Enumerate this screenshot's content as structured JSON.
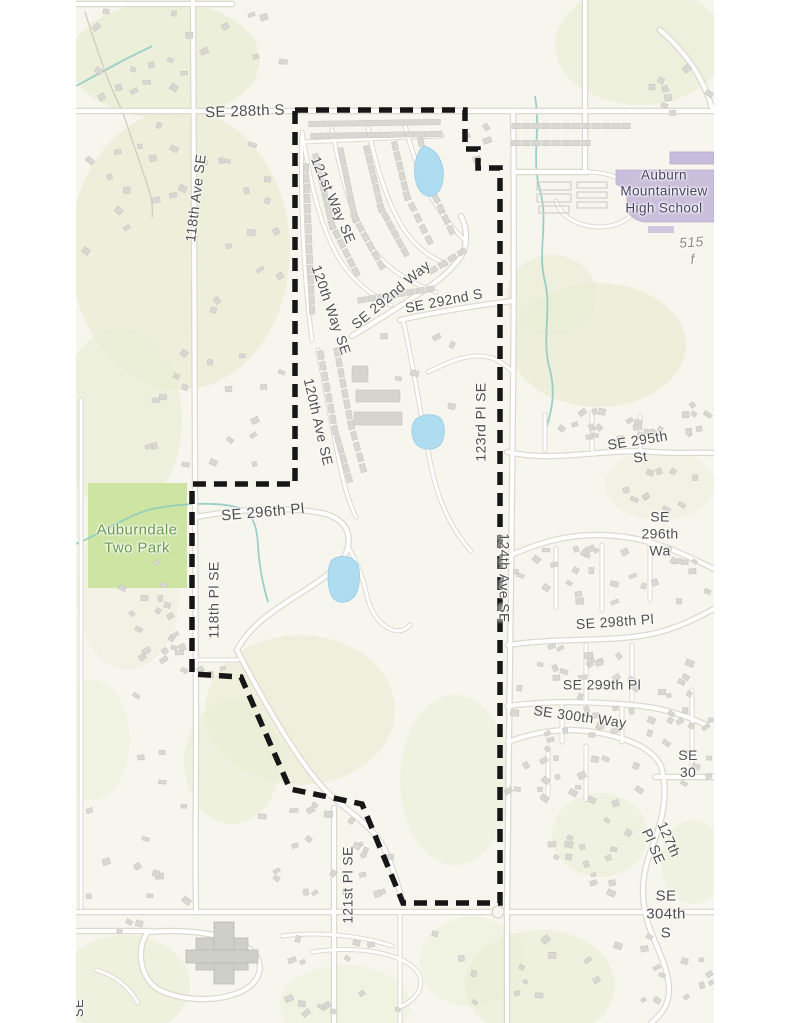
{
  "map": {
    "type": "street-map-with-dashed-site-boundary",
    "colors": {
      "background": "#f7f6ee",
      "margin": "#ffffff",
      "road_fill": "#ffffff",
      "road_casing": "#dcd9cf",
      "woods": "#eaeed6",
      "park": "#cde4a3",
      "water": "#aedcf0",
      "building": "#d8d7d2",
      "school_building": "#c7bddb",
      "boundary": "#161616",
      "street_label": "#4f4f4f",
      "park_label": "#689a4c",
      "school_label": "#494361"
    },
    "labels": [
      {
        "id": "se-288th-st",
        "text": "SE 288th S",
        "x": 245,
        "y": 112,
        "rot": -2,
        "size": 15,
        "cls": "street"
      },
      {
        "id": "118th-ave-se",
        "text": "118th Ave SE",
        "x": 196,
        "y": 198,
        "rot": -83,
        "size": 14,
        "cls": "street"
      },
      {
        "id": "121st-way-se",
        "text": "121st Way SE",
        "x": 333,
        "y": 200,
        "rot": 67,
        "size": 14,
        "cls": "street"
      },
      {
        "id": "120th-way-se",
        "text": "120th Way SE",
        "x": 331,
        "y": 310,
        "rot": 71,
        "size": 14,
        "cls": "street"
      },
      {
        "id": "120th-ave-se",
        "text": "120th Ave SE",
        "x": 318,
        "y": 422,
        "rot": 77,
        "size": 14,
        "cls": "street"
      },
      {
        "id": "se-292nd-way",
        "text": "SE 292nd Way",
        "x": 391,
        "y": 295,
        "rot": -40,
        "size": 14,
        "cls": "street"
      },
      {
        "id": "se-292nd-st",
        "text": "SE 292nd S",
        "x": 444,
        "y": 301,
        "rot": -11,
        "size": 14,
        "cls": "street"
      },
      {
        "id": "123rd-pl-se",
        "text": "123rd Pl SE",
        "x": 481,
        "y": 422,
        "rot": -90,
        "size": 14,
        "cls": "street"
      },
      {
        "id": "124th-ave-se",
        "text": "124th Ave SE",
        "x": 504,
        "y": 578,
        "rot": 90,
        "size": 14,
        "cls": "street"
      },
      {
        "id": "se-296th-pl",
        "text": "SE 296th Pl",
        "x": 263,
        "y": 513,
        "rot": -5,
        "size": 15,
        "cls": "street"
      },
      {
        "id": "118th-pl-se",
        "text": "118th Pl SE",
        "x": 214,
        "y": 600,
        "rot": -90,
        "size": 14,
        "cls": "street"
      },
      {
        "id": "auburndale-two-park",
        "text": "Auburndale\nTwo Park",
        "x": 137,
        "y": 540,
        "rot": 0,
        "size": 15,
        "cls": "park"
      },
      {
        "id": "auburn-mountainview-high-school",
        "text": "Auburn\nMountainview\nHigh School",
        "x": 664,
        "y": 192,
        "rot": 0,
        "size": 13.5,
        "cls": "school"
      },
      {
        "id": "distance-515-ft",
        "text": "515 f",
        "x": 692,
        "y": 251,
        "rot": -4,
        "size": 14,
        "cls": "distance"
      },
      {
        "id": "se-295th-st",
        "text": "SE 295th St",
        "x": 639,
        "y": 449,
        "rot": -9,
        "size": 14,
        "cls": "street"
      },
      {
        "id": "se-296th-way",
        "text": "SE 296th Wa",
        "x": 660,
        "y": 534,
        "rot": 0,
        "size": 14,
        "cls": "street"
      },
      {
        "id": "se-298th-pl",
        "text": "SE 298th Pl",
        "x": 615,
        "y": 622,
        "rot": -4,
        "size": 14,
        "cls": "street"
      },
      {
        "id": "se-299th-pl",
        "text": "SE 299th Pl",
        "x": 602,
        "y": 685,
        "rot": 0,
        "size": 14,
        "cls": "street"
      },
      {
        "id": "se-300th-way",
        "text": "SE 300th Way",
        "x": 580,
        "y": 717,
        "rot": 8,
        "size": 14,
        "cls": "street"
      },
      {
        "id": "se-30x",
        "text": "SE 30",
        "x": 688,
        "y": 764,
        "rot": 0,
        "size": 14,
        "cls": "street"
      },
      {
        "id": "127th-pl-se",
        "text": "127th Pl SE",
        "x": 661,
        "y": 843,
        "rot": 66,
        "size": 14,
        "cls": "street"
      },
      {
        "id": "se-304th-st",
        "text": "SE 304th S",
        "x": 666,
        "y": 915,
        "rot": 0,
        "size": 15,
        "cls": "street"
      },
      {
        "id": "121st-pl-se",
        "text": "121st Pl SE",
        "x": 348,
        "y": 885,
        "rot": -90,
        "size": 14,
        "cls": "street"
      },
      {
        "id": "edge-label-se",
        "text": "SE",
        "x": 79,
        "y": 1008,
        "rot": -90,
        "size": 13,
        "cls": "street"
      }
    ]
  }
}
